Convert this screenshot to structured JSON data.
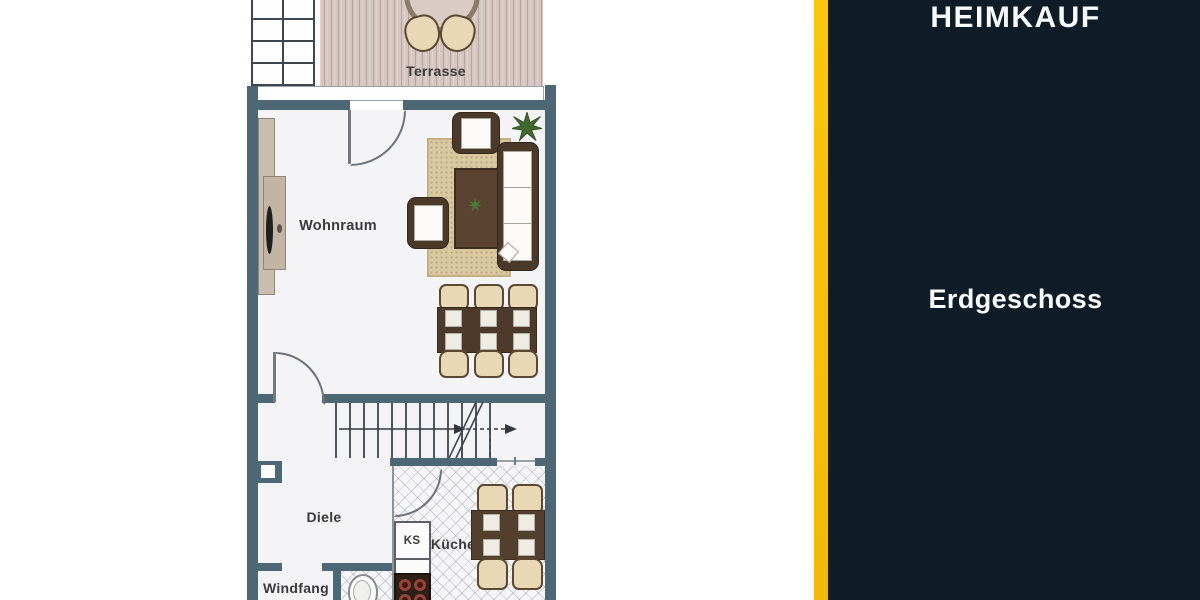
{
  "brand_panel": {
    "brand": "HEIMKAUF",
    "title": "Erdgeschoss"
  },
  "floorplan": {
    "room_labels": {
      "terrasse": "Terrasse",
      "wohnraum": "Wohnraum",
      "diele": "Diele",
      "windfang": "Windfang",
      "kueche": "Küche",
      "ks": "KS"
    }
  },
  "colors": {
    "accent_yellow": "#f9c312",
    "panel_navy": "#0d1c27",
    "wall_slate": "#4d6775",
    "terrace_wood": "#d6c6c2",
    "rug_tan": "#d9c8a0",
    "furniture_brown": "#4a3829",
    "chair_beige": "#e8d8b6",
    "label_text": "#3a3a3a"
  }
}
